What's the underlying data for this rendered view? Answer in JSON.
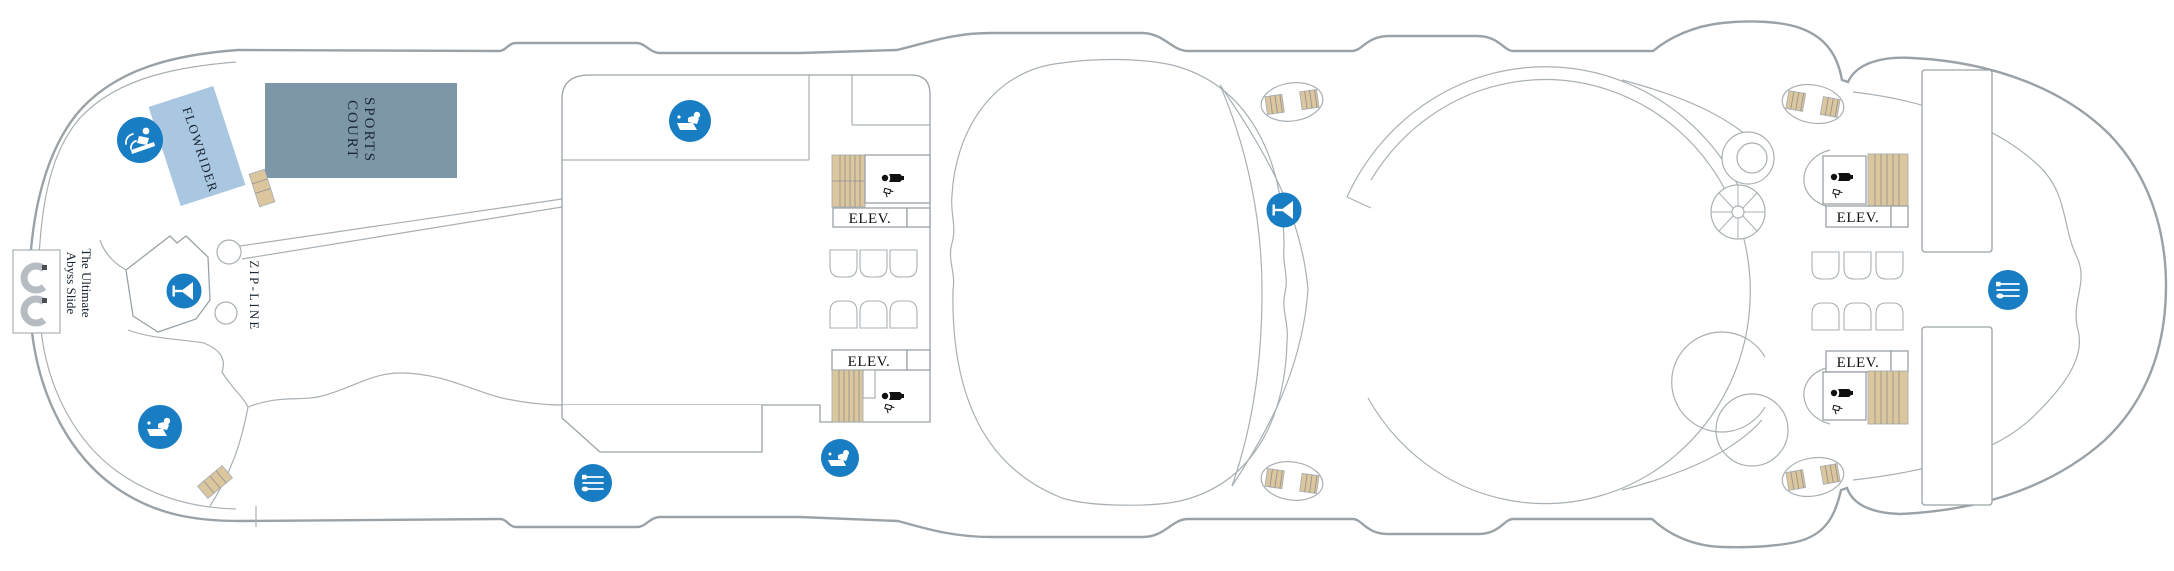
{
  "deck_plan": {
    "labels": {
      "flowrider": "FLOWRIDER",
      "sports_court": {
        "line1": "SPORTS",
        "line2": "COURT"
      },
      "ultimate_abyss": {
        "line1": "The Ultimate",
        "line2": "Abyss Slide"
      },
      "zipline": "ZIP-LINE",
      "elevator": "ELEV."
    },
    "icons": [
      {
        "name": "surfing-icon",
        "meaning": "FlowRider surf simulator"
      },
      {
        "name": "bar-martini-icon",
        "meaning": "Bar"
      },
      {
        "name": "table-tennis-icon",
        "meaning": "Sports / table tennis activity"
      },
      {
        "name": "dining-icon",
        "meaning": "Dining venue"
      },
      {
        "name": "restroom-person-icon",
        "meaning": "Restroom"
      },
      {
        "name": "hair-dryer-icon",
        "meaning": "Restroom amenity"
      }
    ],
    "colors": {
      "amenity_blue": "#187dc2",
      "flowrider_blue": "#a9c7e1",
      "sports_court_slate": "#7d97a9",
      "stair_tan": "#dcc69d",
      "outline_gray": "#9aa2a8",
      "label_navy": "#1a2535"
    }
  }
}
